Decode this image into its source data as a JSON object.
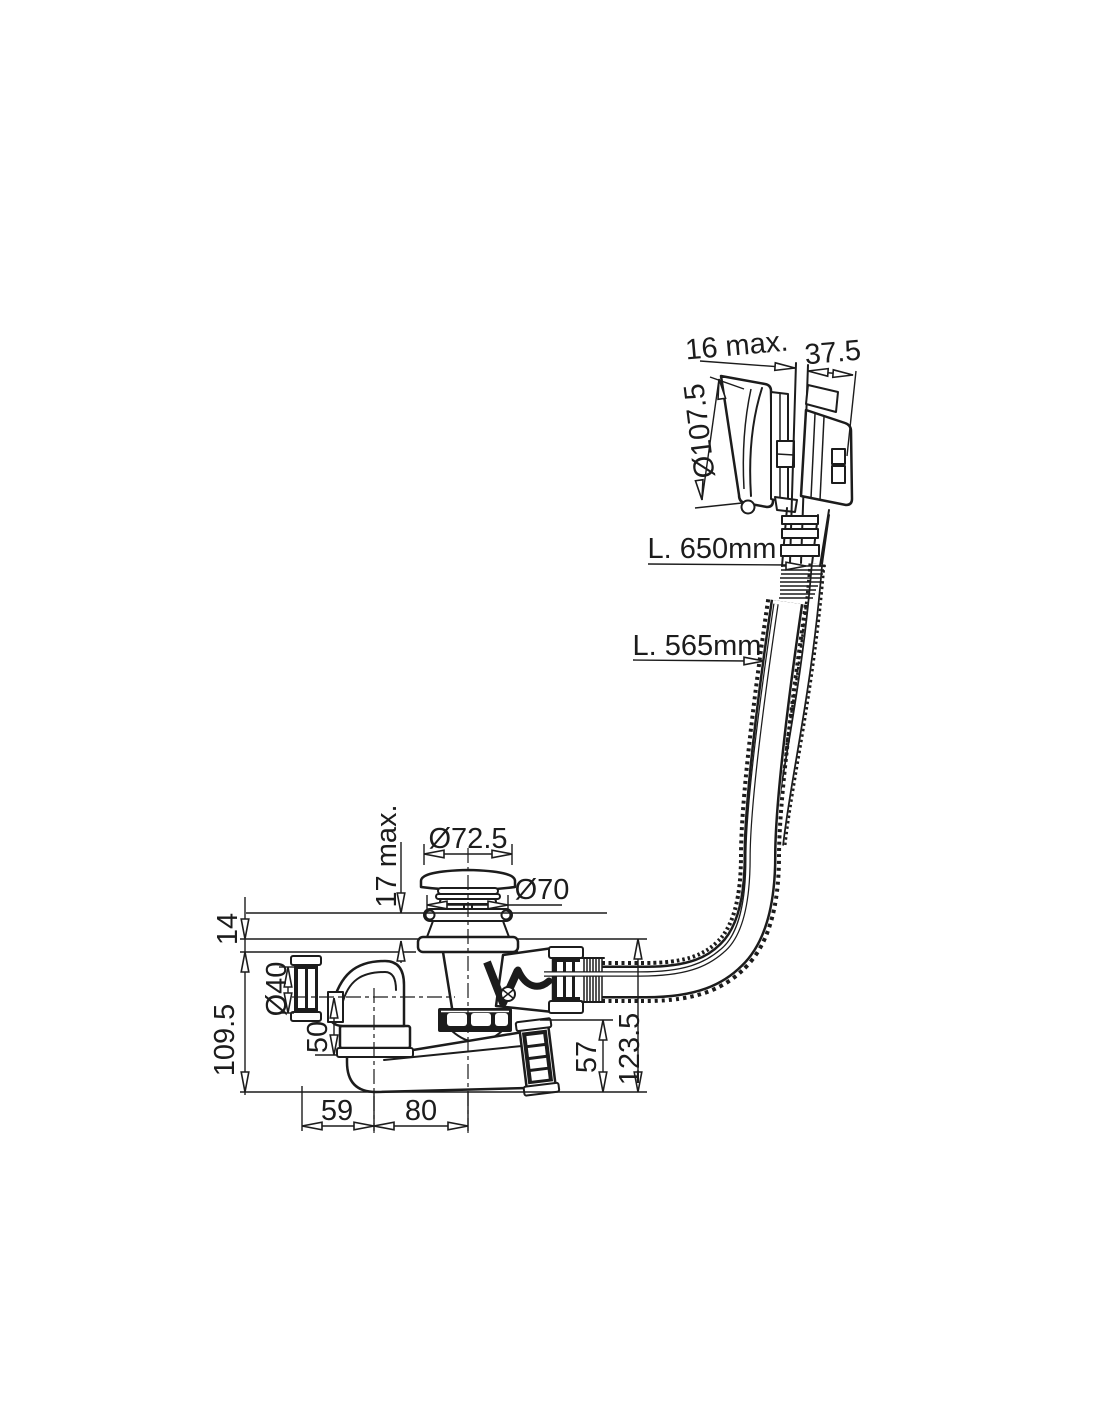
{
  "drawing": {
    "type": "bath-waste-overflow-dimension-drawing",
    "line_color": "#1c1c1c",
    "background_color": "#ffffff",
    "dimensions": {
      "overflow_panel_gap": "16 max.",
      "overflow_projection": "37.5",
      "overflow_cap_diameter": "Ø107.5",
      "cable_length": "L. 650mm",
      "hose_length": "L. 565mm",
      "plug_diameter": "Ø72.5",
      "waste_flange_diameter": "Ø70",
      "rim_thickness_max": "17 max.",
      "flange_height": "14",
      "body_depth": "109.5",
      "outlet_diameter": "Ø40",
      "outlet_drop": "50",
      "elbow_offset": "59",
      "waste_offset": "80",
      "pipe_height": "57",
      "total_depth": "123.5"
    }
  }
}
